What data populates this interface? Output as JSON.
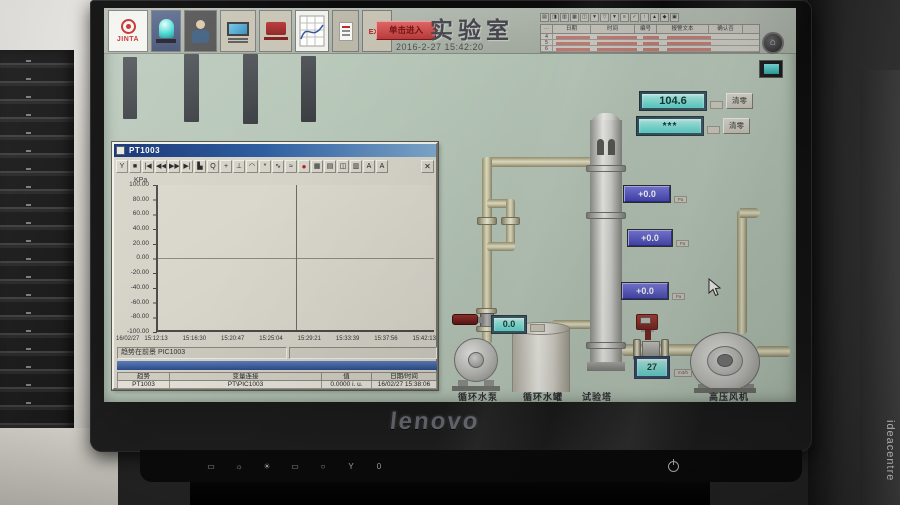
{
  "window": {
    "brand": "lenovo",
    "side_label": "ideacentre",
    "buttons": [
      "▭",
      "☼",
      "☀",
      "▭",
      "○",
      "Y",
      "0"
    ]
  },
  "toolbar": {
    "logo_text": "JINTA",
    "exit_label": "EXIT",
    "enter_button_label": "单击进入"
  },
  "header": {
    "title": "实验室",
    "datetime": "2016-2-27 15:42:20"
  },
  "alarm_panel": {
    "toolbar_icons": [
      "▤",
      "◨",
      "▥",
      "▦",
      "◫",
      "▼",
      "▽",
      "▼",
      "≡",
      "✓",
      "↑",
      "▲",
      "◆",
      "▣"
    ],
    "headers": [
      "日期",
      "时间",
      "编号",
      "报警文本",
      "确认否"
    ],
    "row_numbers": [
      "4",
      "5",
      "6"
    ],
    "home_icon": "⌂"
  },
  "trend_window": {
    "title": "PT1003",
    "toolbar_icons": [
      "Y",
      "■",
      "|◀",
      "◀◀",
      "▶▶",
      "▶|",
      "▙",
      "Q",
      "+",
      "⊥",
      "◠",
      "*",
      "∿",
      "≈",
      "●",
      "▦",
      "▤",
      "◫",
      "▥",
      "A",
      "A"
    ],
    "close_glyph": "✕",
    "status_left": "趋势在前景 PIC1003",
    "table_headers": [
      "趋势",
      "变量连接",
      "值",
      "日期/时间"
    ],
    "table_row": [
      "PT1003",
      "PT\\PIC1003",
      "0.0000 i. u.",
      "16/02/27 15:38:06"
    ]
  },
  "chart_data": {
    "type": "line",
    "title": "PT1003",
    "xlabel": "",
    "ylabel": "KPa",
    "ylim": [
      -100,
      100
    ],
    "y_ticks": [
      "100.00",
      "80.00",
      "60.00",
      "40.00",
      "20.00",
      "0.00",
      "-20.00",
      "-40.00",
      "-60.00",
      "-80.00",
      "-100.00"
    ],
    "x_date": "16/02/27",
    "x_ticks": [
      "15:12:13",
      "15:16:30",
      "15:20:47",
      "15:25:04",
      "15:29:21",
      "15:33:39",
      "15:37:56",
      "15:42:13"
    ],
    "series": [
      {
        "name": "PT1003",
        "values": []
      }
    ],
    "grid": "zero-line and center cursor only",
    "legend": "none"
  },
  "displays": {
    "big1": "104.6",
    "big2": "***",
    "clear_label": "清零",
    "pressure_values": [
      "+0.0",
      "+0.0",
      "+0.0"
    ],
    "pressure_unit": "Pa",
    "valve_flow": "0.0",
    "fan_flow": "27",
    "fan_flow_unit": "m3/h"
  },
  "equipment_labels": {
    "pump": "循环水泵",
    "tank": "循环水罐",
    "tower": "试验塔",
    "fan": "高压风机"
  }
}
